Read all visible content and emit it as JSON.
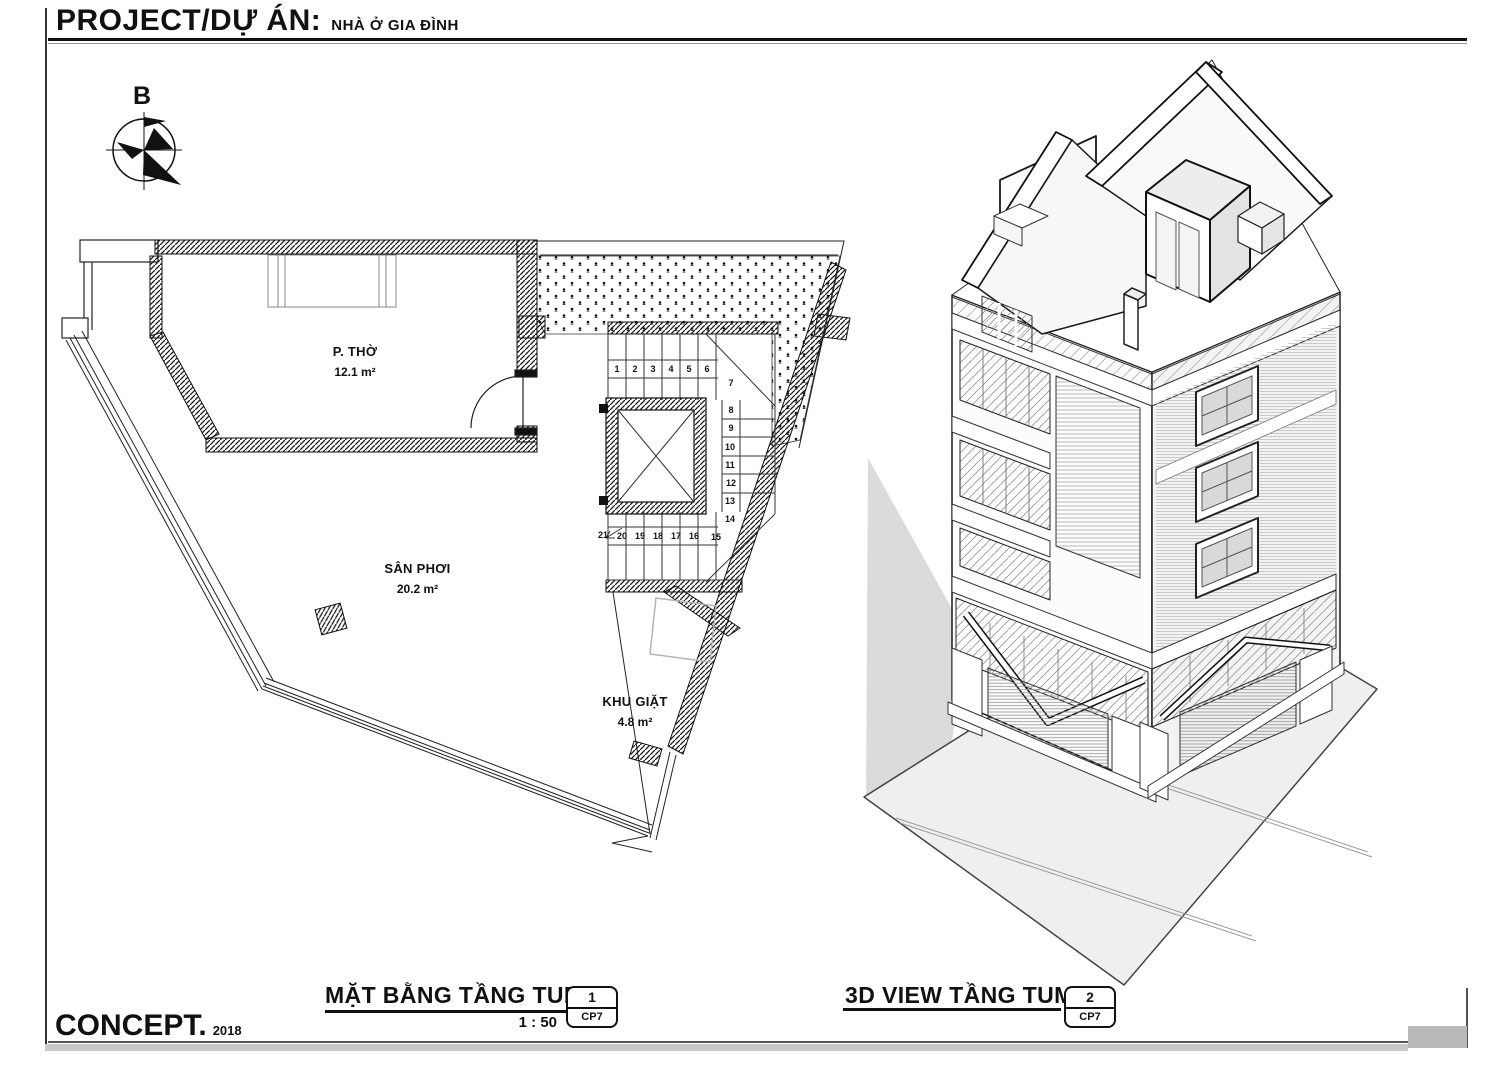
{
  "page": {
    "project_label": "PROJECT/DỰ ÁN:",
    "project_name": "NHÀ Ở GIA ĐÌNH",
    "brand": "CONCEPT.",
    "year": "2018"
  },
  "compass": {
    "label": "B"
  },
  "plan": {
    "title": "MẶT BẰNG TẦNG TUM",
    "scale": "1 : 50",
    "tag": {
      "number": "1",
      "code": "CP7"
    },
    "rooms": {
      "tho": {
        "name": "P. THỜ",
        "area": "12.1 m²"
      },
      "san": {
        "name": "SÂN PHƠI",
        "area": "20.2 m²"
      },
      "giat": {
        "name": "KHU GIẶT",
        "area": "4.8 m²"
      }
    },
    "stairs": {
      "n1": "1",
      "n2": "2",
      "n3": "3",
      "n4": "4",
      "n5": "5",
      "n6": "6",
      "n7": "7",
      "n8": "8",
      "n9": "9",
      "n10": "10",
      "n11": "11",
      "n12": "12",
      "n13": "13",
      "n14": "14",
      "n15": "15",
      "n16": "16",
      "n17": "17",
      "n18": "18",
      "n19": "19",
      "n20": "20",
      "n21": "21"
    }
  },
  "view3d": {
    "title": "3D VIEW TẦNG TUM",
    "tag": {
      "number": "2",
      "code": "CP7"
    }
  },
  "colors": {
    "line": "#111111",
    "shadow": "#dbdbdb",
    "pavement": "#efefef",
    "strip": "#c9c9c9"
  }
}
